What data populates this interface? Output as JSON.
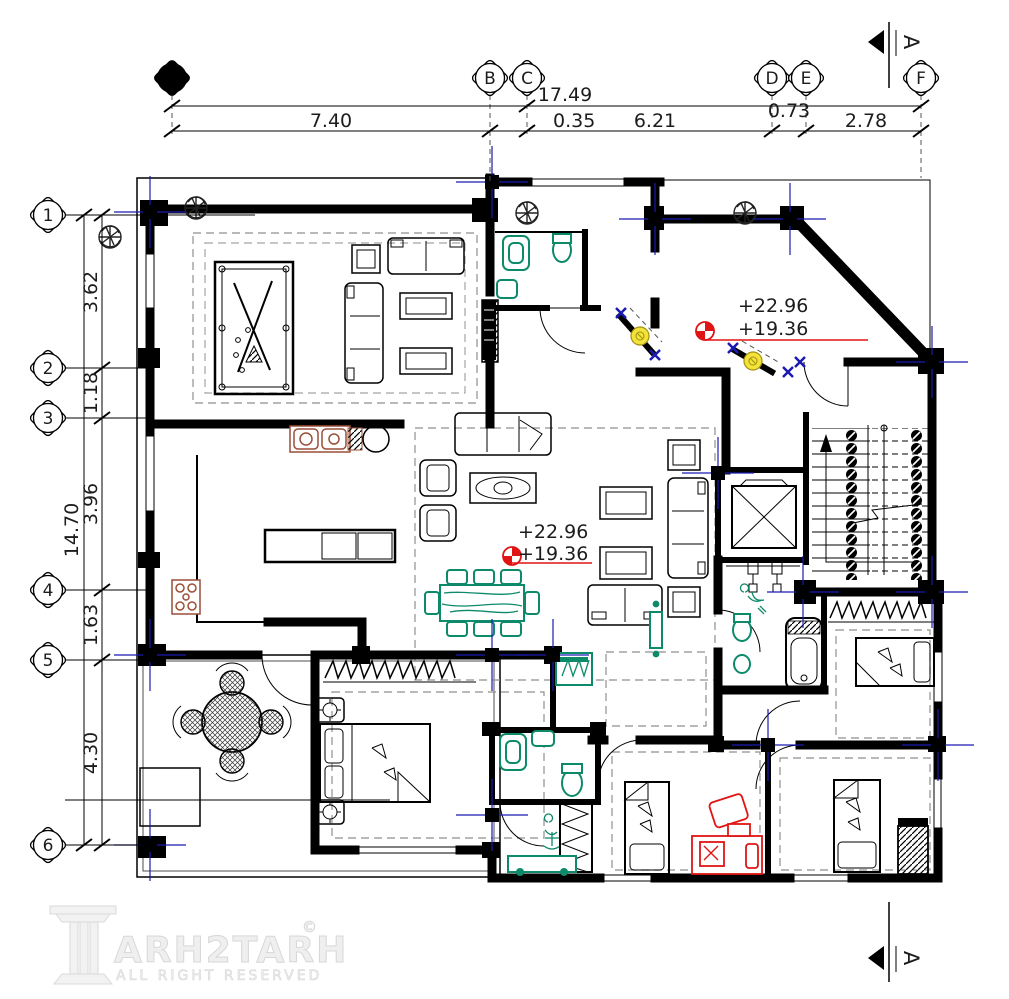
{
  "drawing": {
    "type": "architectural-floor-plan",
    "grid": {
      "columns": [
        {
          "label": "A"
        },
        {
          "label": "B"
        },
        {
          "label": "C"
        },
        {
          "label": "D"
        },
        {
          "label": "E"
        },
        {
          "label": "F"
        }
      ],
      "rows": [
        {
          "label": "1"
        },
        {
          "label": "2"
        },
        {
          "label": "3"
        },
        {
          "label": "4"
        },
        {
          "label": "5"
        },
        {
          "label": "6"
        }
      ]
    },
    "dimensions": {
      "overall_width": "17.49",
      "top_segments": [
        "7.40",
        "0.35",
        "6.21",
        "0.73",
        "2.78"
      ],
      "overall_height": "14.70",
      "left_segments": [
        "3.62",
        "1.18",
        "3.96",
        "1.63",
        "4.30"
      ]
    },
    "elevation_markers": [
      {
        "upper": "+22.96",
        "lower": "+19.36"
      },
      {
        "upper": "+22.96",
        "lower": "+19.36"
      }
    ],
    "section_markers": {
      "top": "A",
      "bottom": "A"
    },
    "logo": {
      "brand": "ARH2TARH",
      "copyright": "©",
      "tagline": "ALL RIGHT RESERVED"
    },
    "colors": {
      "walls": "#000000",
      "sanitary_teal": "#0d8a6a",
      "accent_red": "#e01414",
      "lamp_yellow": "#f2e23a",
      "marker_blue": "#1a1ab0",
      "kitchen_brown": "#9a4f38",
      "ceiling_dash_gray": "#8f8f8f",
      "logo_gray": "#e3e3e3"
    }
  }
}
